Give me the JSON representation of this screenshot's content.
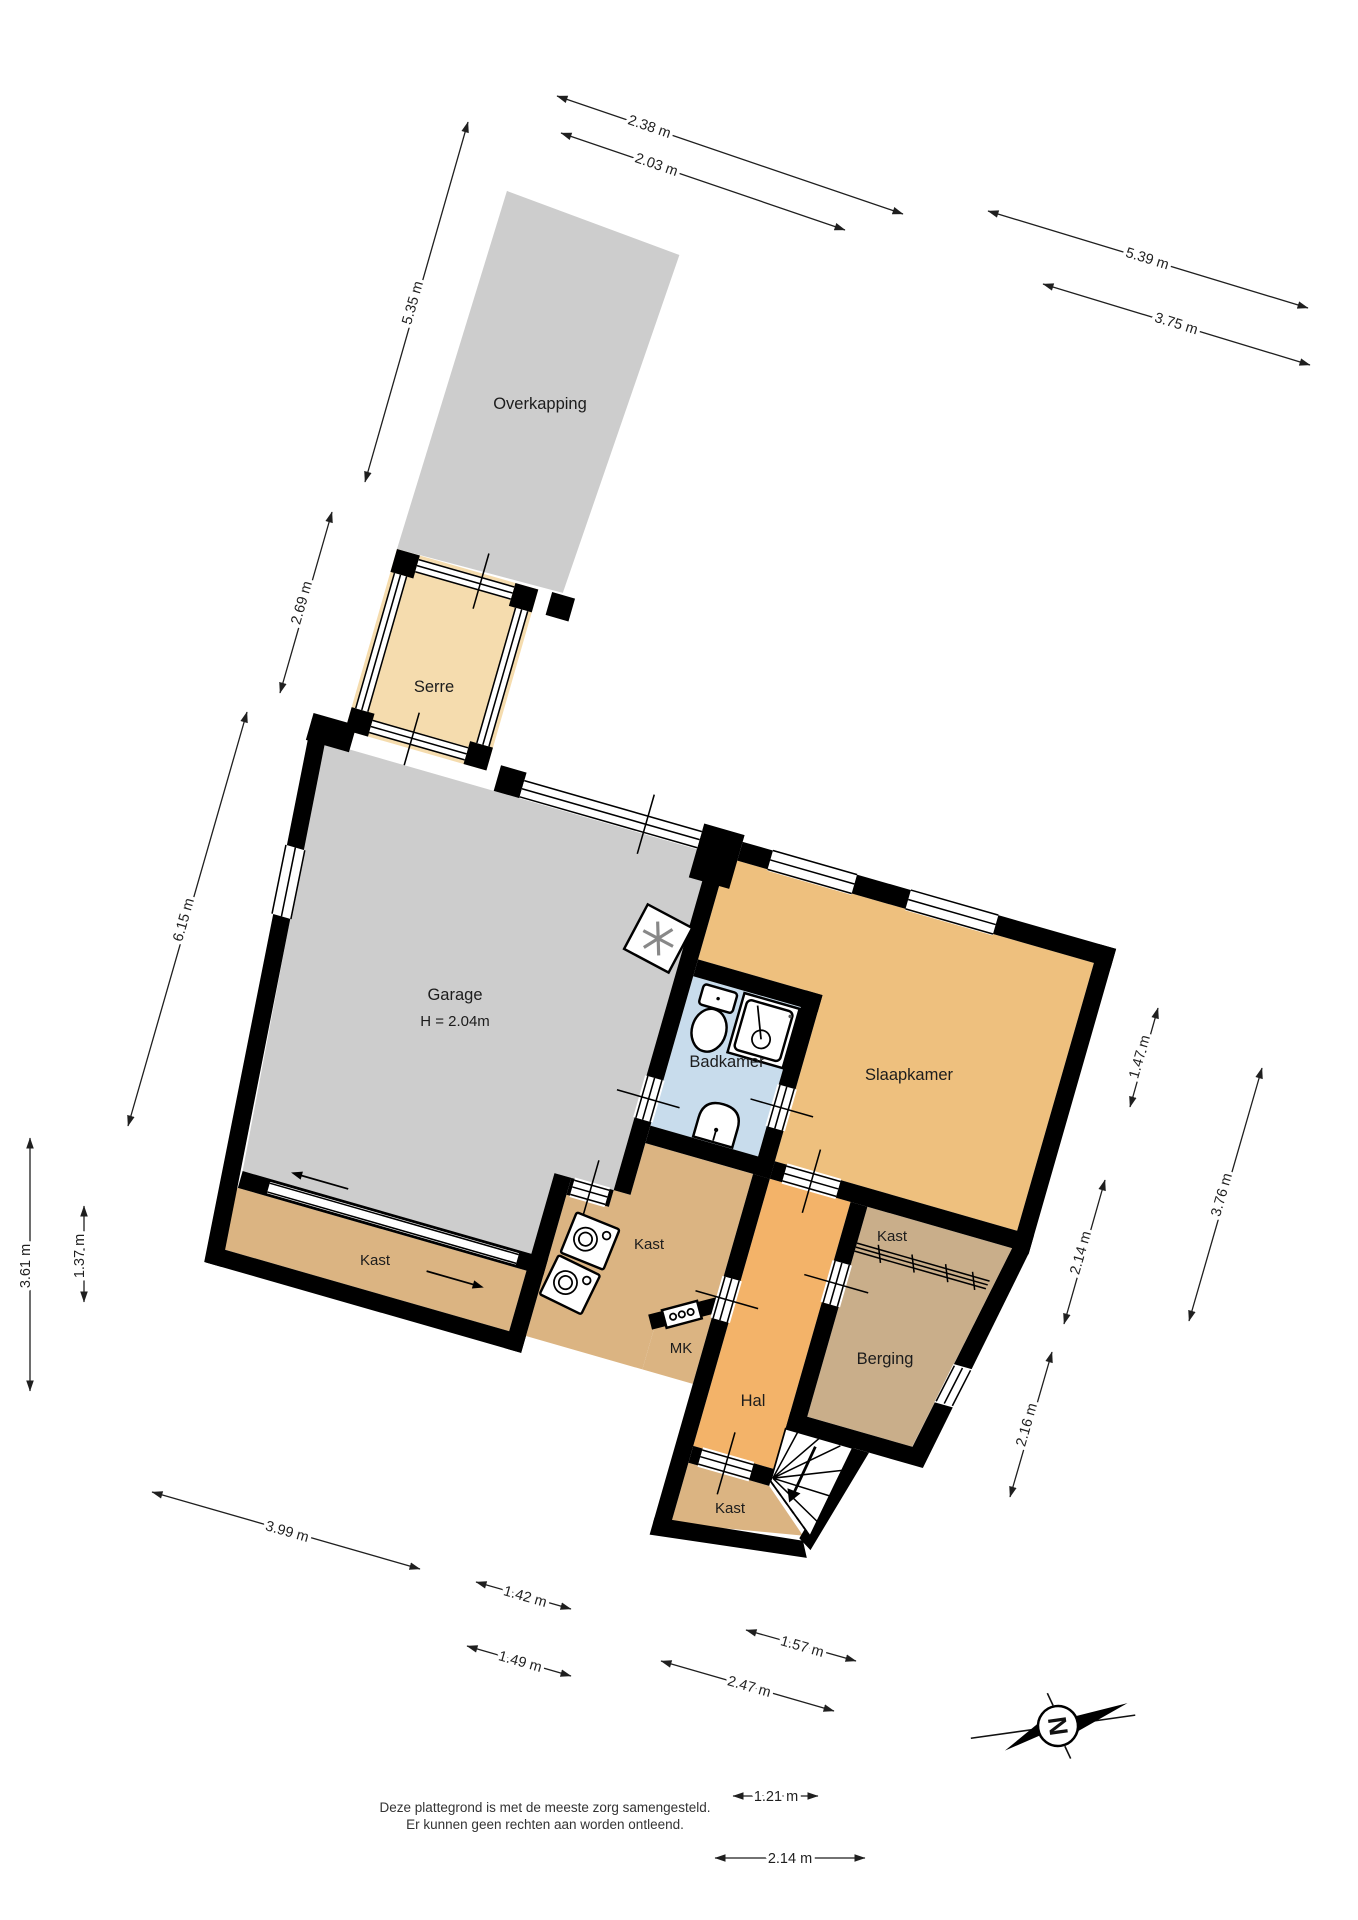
{
  "plan_title": "Begane grond plattegrond",
  "rooms": {
    "overkapping": "Overkapping",
    "serre": "Serre",
    "garage": "Garage",
    "garage_height": "H = 2.04m",
    "badkamer": "Badkamer",
    "slaapkamer": "Slaapkamer",
    "kast": "Kast",
    "mk": "MK",
    "hal": "Hal",
    "berging": "Berging"
  },
  "dims": {
    "top_a": "2.38 m",
    "top_b": "2.03 m",
    "topright_a": "5.39 m",
    "topright_b": "3.75 m",
    "left_a": "5.35 m",
    "left_b": "2.69 m",
    "left_c": "6.15 m",
    "left_d": "1.37 m",
    "left_e": "3.61 m",
    "right_a": "1.47 m",
    "right_b": "3.76 m",
    "right_c": "2.14 m",
    "right_d": "2.16 m",
    "bottom_a": "3.99 m",
    "bottom_b": "1.42 m",
    "bottom_c": "1.49 m",
    "bottom_d": "1.57 m",
    "bottom_e": "2.47 m",
    "bottom_f": "1.21 m",
    "bottom_g": "2.14 m"
  },
  "compass": {
    "north": "N"
  },
  "disclaimer": {
    "line1": "Deze plattegrond is met de meeste zorg samengesteld.",
    "line2": "Er kunnen geen rechten aan worden ontleend."
  },
  "colors": {
    "wall": "#000000",
    "garage_gray": "#cdcdcd",
    "serre_tan": "#f5dcae",
    "slaapkamer_orange": "#eec07e",
    "hal_orange": "#f3b369",
    "kast_tan": "#dbb482",
    "berging_brown": "#c9ae8a",
    "badkamer_blue": "#c8dcec"
  }
}
